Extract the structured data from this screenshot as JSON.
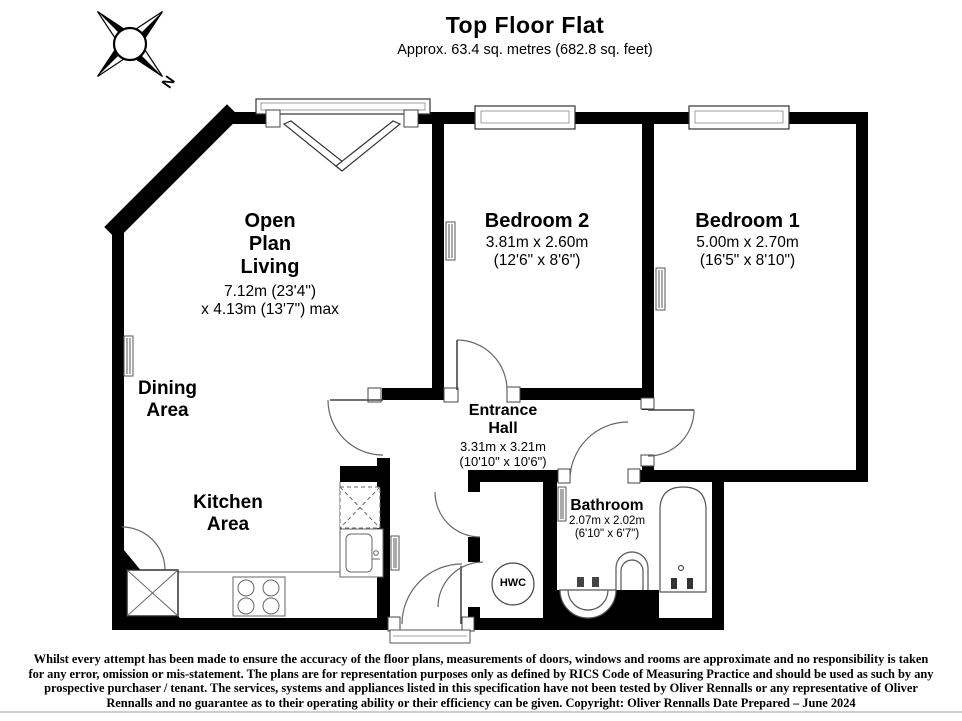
{
  "header": {
    "title": "Top Floor Flat",
    "subtitle": "Approx. 63.4 sq. metres (682.8 sq. feet)",
    "compass": "N"
  },
  "rooms": {
    "living": {
      "name": "Open\nPlan\nLiving",
      "dims": "7.12m (23'4\")\nx 4.13m (13'7\") max"
    },
    "dining": {
      "name": "Dining\nArea"
    },
    "kitchen": {
      "name": "Kitchen\nArea"
    },
    "bedroom2": {
      "name": "Bedroom 2",
      "dims": "3.81m x 2.60m\n(12'6\" x 8'6\")"
    },
    "bedroom1": {
      "name": "Bedroom 1",
      "dims": "5.00m x 2.70m\n(16'5\" x 8'10\")"
    },
    "hall": {
      "name": "Entrance\nHall",
      "dims": "3.31m x 3.21m\n(10'10\" x 10'6\")"
    },
    "bathroom": {
      "name": "Bathroom",
      "dims": "2.07m x 2.02m\n(6'10\" x 6'7\")"
    },
    "hwc": {
      "name": "HWC"
    }
  },
  "footer": {
    "line1": "Whilst every attempt has been made to ensure the accuracy of the floor plans, measurements of doors, windows and rooms are approximate and no responsibility is taken",
    "line2": "for any error, omission or mis-statement. The plans are for representation purposes only as defined by RICS Code of Measuring Practice and should be used as such by any",
    "line3": "prospective purchaser / tenant. The services, systems and appliances listed in this specification have not been tested by Oliver Rennalls or any representative of Oliver",
    "line4": "Rennalls and no guarantee as to their operating ability or their efficiency can be given. Copyright: Oliver Rennalls Date Prepared – June 2024"
  },
  "colors": {
    "wall": "#000000",
    "line": "#555555",
    "rule": "#c9cdd6"
  }
}
